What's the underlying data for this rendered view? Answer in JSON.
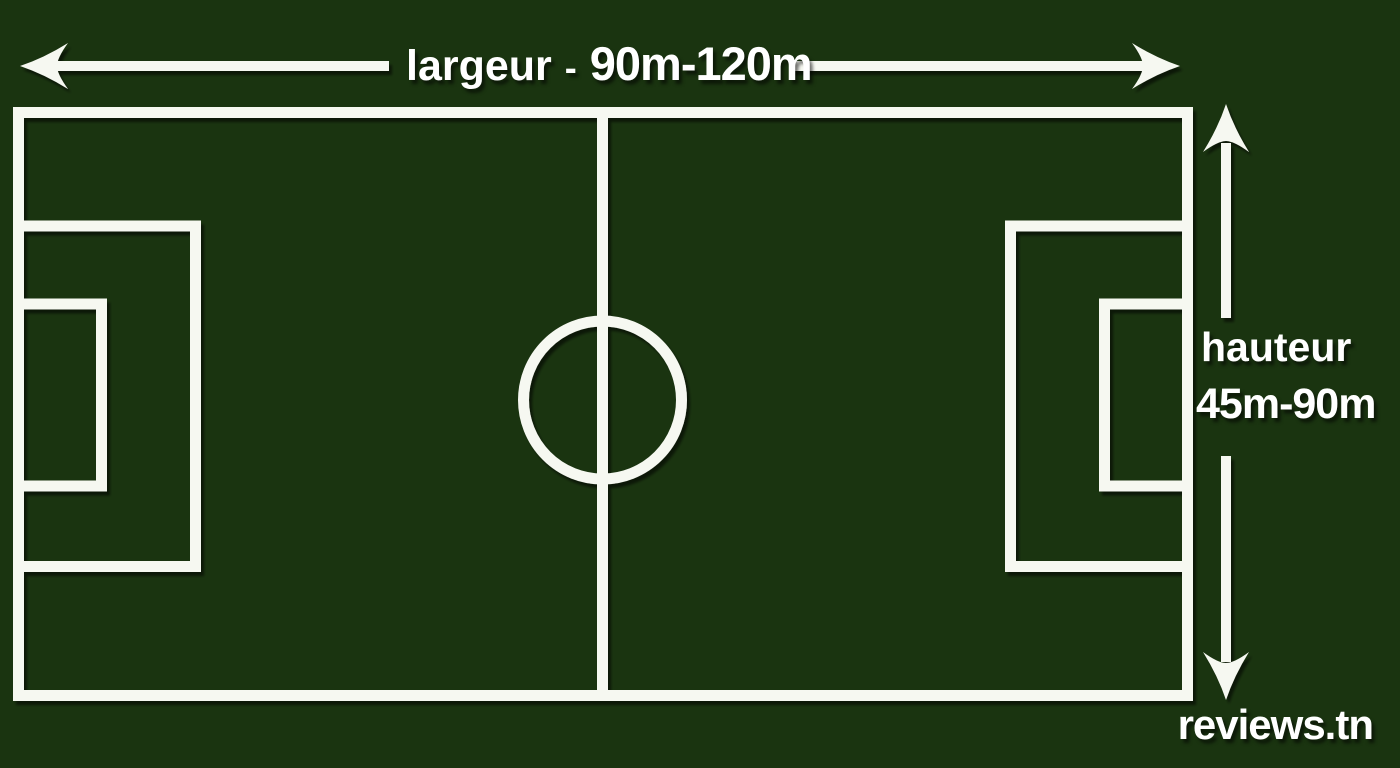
{
  "page": {
    "title": "Dimensions d'un terrain de football"
  },
  "colors": {
    "background": "#1a3410",
    "line": "#f6f8f1",
    "text": "#ffffff"
  },
  "labels": {
    "width_label": "largeur",
    "width_separator": "-",
    "width_range": "90m-120m",
    "height_label": "hauteur",
    "height_range": "45m-90m",
    "watermark": "reviews.tn"
  },
  "diagram": {
    "type": "football-pitch-top-view",
    "features": [
      "outer boundary",
      "halfway line",
      "center circle",
      "left penalty area",
      "left goal area",
      "right penalty area",
      "right goal area",
      "horizontal double-headed width arrow",
      "vertical double-headed height arrow"
    ]
  }
}
